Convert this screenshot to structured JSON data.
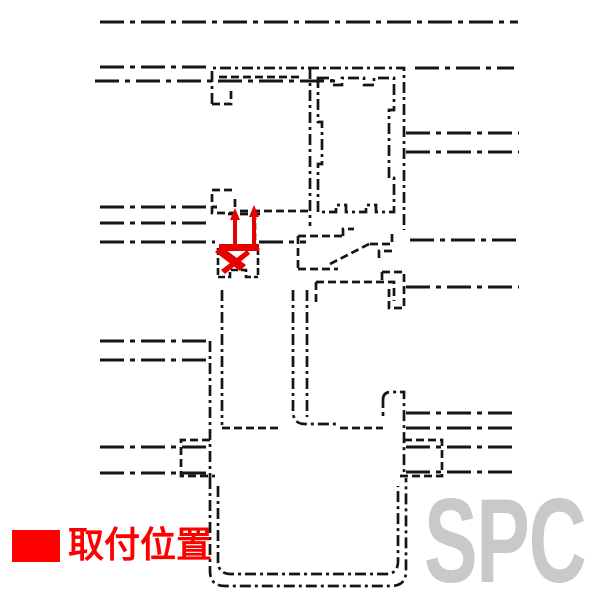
{
  "colors": {
    "line": "#151515",
    "highlight": "#e60000",
    "legend": "#ff0000",
    "watermark": "#c9c9c9"
  },
  "legend": {
    "label": "取付位置"
  },
  "watermark": {
    "text": "SPC"
  },
  "diagram": {
    "marker": "mounting-position-marker"
  }
}
